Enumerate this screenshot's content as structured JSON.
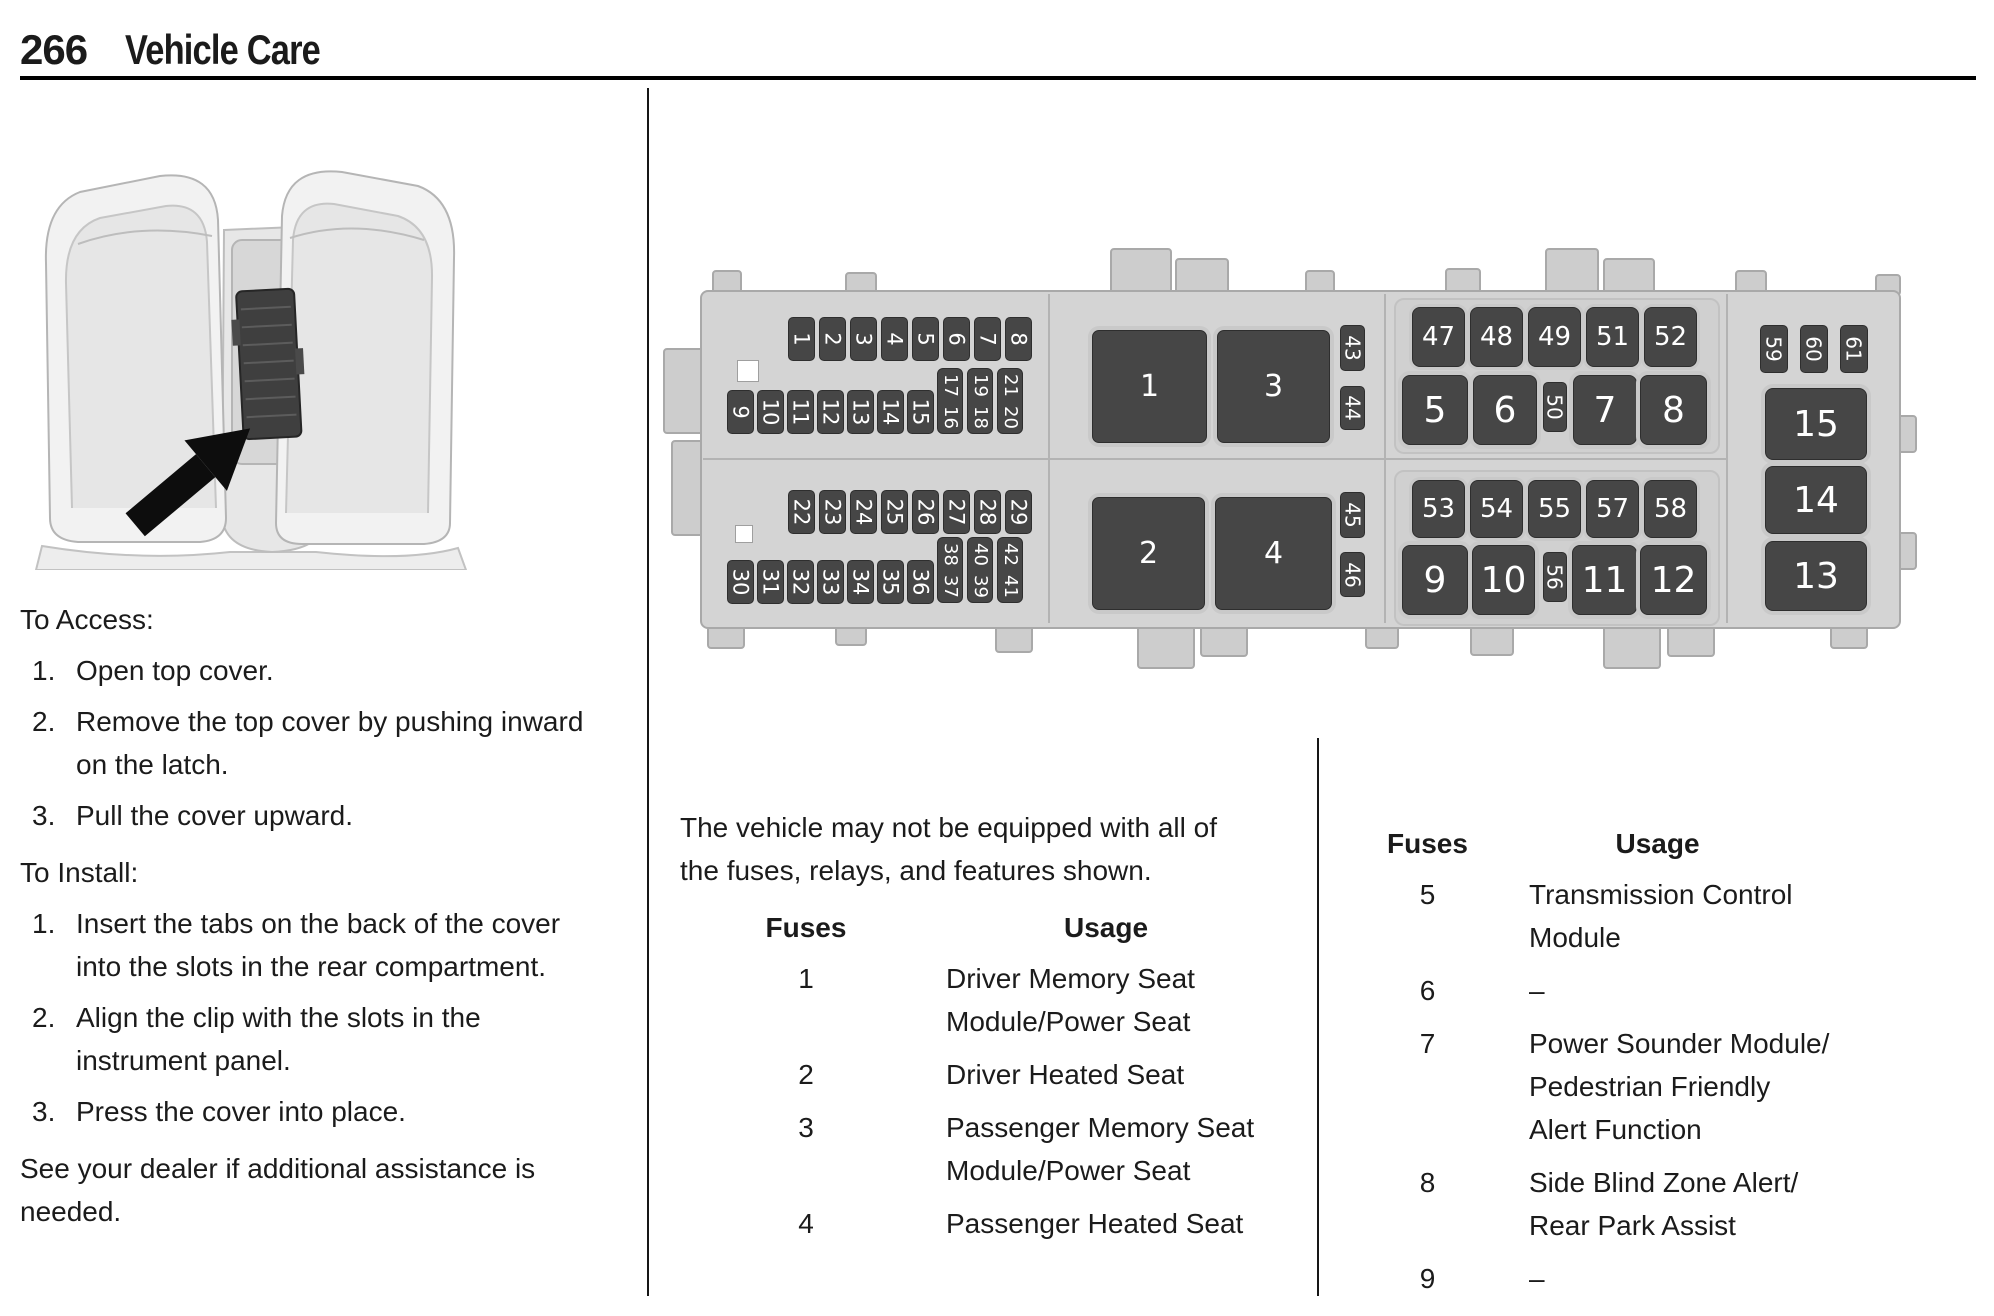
{
  "page": {
    "number": "266",
    "section_title": "Vehicle Care"
  },
  "left_column": {
    "access_heading": "To Access:",
    "access_steps": [
      {
        "num": "1.",
        "lines": [
          "Open top cover."
        ]
      },
      {
        "num": "2.",
        "lines": [
          "Remove the top cover by pushing inward",
          "on the latch."
        ]
      },
      {
        "num": "3.",
        "lines": [
          "Pull the cover upward."
        ]
      }
    ],
    "install_heading": "To Install:",
    "install_steps": [
      {
        "num": "1.",
        "lines": [
          "Insert the tabs on the back of the cover",
          "into the slots in the rear compartment."
        ]
      },
      {
        "num": "2.",
        "lines": [
          "Align the clip with the slots in the",
          "instrument panel."
        ]
      },
      {
        "num": "3.",
        "lines": [
          "Press the cover into place."
        ]
      }
    ],
    "dealer_note_lines": [
      "See your dealer if additional assistance is",
      "needed."
    ]
  },
  "middle_column": {
    "equipment_note_lines": [
      "The vehicle may not be equipped with all of",
      "the fuses, relays, and features shown."
    ],
    "table": {
      "fuses_header": "Fuses",
      "usage_header": "Usage",
      "rows": [
        {
          "fuse": "1",
          "usage_lines": [
            "Driver Memory Seat",
            "Module/Power Seat"
          ]
        },
        {
          "fuse": "2",
          "usage_lines": [
            "Driver Heated Seat"
          ]
        },
        {
          "fuse": "3",
          "usage_lines": [
            "Passenger Memory Seat",
            "Module/Power Seat"
          ]
        },
        {
          "fuse": "4",
          "usage_lines": [
            "Passenger Heated Seat"
          ]
        }
      ]
    }
  },
  "right_column": {
    "table": {
      "fuses_header": "Fuses",
      "usage_header": "Usage",
      "rows": [
        {
          "fuse": "5",
          "usage_lines": [
            "Transmission Control",
            "Module"
          ]
        },
        {
          "fuse": "6",
          "usage_lines": [
            "–"
          ]
        },
        {
          "fuse": "7",
          "usage_lines": [
            "Power Sounder Module/",
            "Pedestrian Friendly",
            "Alert Function"
          ]
        },
        {
          "fuse": "8",
          "usage_lines": [
            "Side Blind Zone Alert/",
            "Rear Park Assist"
          ]
        },
        {
          "fuse": "9",
          "usage_lines": [
            "–"
          ]
        }
      ]
    }
  },
  "diagram": {
    "fuses": [
      {
        "kind": "small",
        "label": "1",
        "x": 243,
        "y": 77,
        "w": 27,
        "h": 44
      },
      {
        "kind": "small",
        "label": "2",
        "x": 274,
        "y": 77,
        "w": 27,
        "h": 44
      },
      {
        "kind": "small",
        "label": "3",
        "x": 305,
        "y": 77,
        "w": 27,
        "h": 44
      },
      {
        "kind": "small",
        "label": "4",
        "x": 336,
        "y": 77,
        "w": 27,
        "h": 44
      },
      {
        "kind": "small",
        "label": "5",
        "x": 367,
        "y": 77,
        "w": 27,
        "h": 44
      },
      {
        "kind": "small",
        "label": "6",
        "x": 398,
        "y": 77,
        "w": 27,
        "h": 44
      },
      {
        "kind": "small",
        "label": "7",
        "x": 429,
        "y": 77,
        "w": 27,
        "h": 44
      },
      {
        "kind": "small",
        "label": "8",
        "x": 460,
        "y": 77,
        "w": 27,
        "h": 44
      },
      {
        "kind": "small",
        "label": "9",
        "x": 182,
        "y": 150,
        "w": 27,
        "h": 44
      },
      {
        "kind": "small",
        "label": "10",
        "x": 212,
        "y": 150,
        "w": 27,
        "h": 44
      },
      {
        "kind": "small",
        "label": "11",
        "x": 242,
        "y": 150,
        "w": 27,
        "h": 44
      },
      {
        "kind": "small",
        "label": "12",
        "x": 272,
        "y": 150,
        "w": 27,
        "h": 44
      },
      {
        "kind": "small",
        "label": "13",
        "x": 302,
        "y": 150,
        "w": 27,
        "h": 44
      },
      {
        "kind": "small",
        "label": "14",
        "x": 332,
        "y": 150,
        "w": 27,
        "h": 44
      },
      {
        "kind": "small",
        "label": "15",
        "x": 362,
        "y": 150,
        "w": 27,
        "h": 44
      },
      {
        "kind": "pair",
        "labels": [
          "17",
          "16"
        ],
        "x": 392,
        "y": 128,
        "w": 26,
        "h": 66
      },
      {
        "kind": "pair",
        "labels": [
          "19",
          "18"
        ],
        "x": 422,
        "y": 128,
        "w": 26,
        "h": 66
      },
      {
        "kind": "pair",
        "labels": [
          "21",
          "20"
        ],
        "x": 452,
        "y": 128,
        "w": 26,
        "h": 66
      },
      {
        "kind": "small",
        "label": "22",
        "x": 243,
        "y": 250,
        "w": 27,
        "h": 44
      },
      {
        "kind": "small",
        "label": "23",
        "x": 274,
        "y": 250,
        "w": 27,
        "h": 44
      },
      {
        "kind": "small",
        "label": "24",
        "x": 305,
        "y": 250,
        "w": 27,
        "h": 44
      },
      {
        "kind": "small",
        "label": "25",
        "x": 336,
        "y": 250,
        "w": 27,
        "h": 44
      },
      {
        "kind": "small",
        "label": "26",
        "x": 367,
        "y": 250,
        "w": 27,
        "h": 44
      },
      {
        "kind": "small",
        "label": "27",
        "x": 398,
        "y": 250,
        "w": 27,
        "h": 44
      },
      {
        "kind": "small",
        "label": "28",
        "x": 429,
        "y": 250,
        "w": 27,
        "h": 44
      },
      {
        "kind": "small",
        "label": "29",
        "x": 460,
        "y": 250,
        "w": 27,
        "h": 44
      },
      {
        "kind": "small",
        "label": "30",
        "x": 182,
        "y": 320,
        "w": 27,
        "h": 44
      },
      {
        "kind": "small",
        "label": "31",
        "x": 212,
        "y": 320,
        "w": 27,
        "h": 44
      },
      {
        "kind": "small",
        "label": "32",
        "x": 242,
        "y": 320,
        "w": 27,
        "h": 44
      },
      {
        "kind": "small",
        "label": "33",
        "x": 272,
        "y": 320,
        "w": 27,
        "h": 44
      },
      {
        "kind": "small",
        "label": "34",
        "x": 302,
        "y": 320,
        "w": 27,
        "h": 44
      },
      {
        "kind": "small",
        "label": "35",
        "x": 332,
        "y": 320,
        "w": 27,
        "h": 44
      },
      {
        "kind": "small",
        "label": "36",
        "x": 362,
        "y": 320,
        "w": 27,
        "h": 44
      },
      {
        "kind": "pair",
        "labels": [
          "38",
          "37"
        ],
        "x": 392,
        "y": 297,
        "w": 26,
        "h": 66
      },
      {
        "kind": "pair",
        "labels": [
          "40",
          "39"
        ],
        "x": 422,
        "y": 297,
        "w": 26,
        "h": 66
      },
      {
        "kind": "pair",
        "labels": [
          "42",
          "41"
        ],
        "x": 452,
        "y": 297,
        "w": 26,
        "h": 66
      },
      {
        "kind": "relay",
        "label": "1",
        "x": 547,
        "y": 90,
        "w": 115,
        "h": 113
      },
      {
        "kind": "relay",
        "label": "3",
        "x": 672,
        "y": 90,
        "w": 113,
        "h": 113
      },
      {
        "kind": "tiny",
        "label": "43",
        "x": 795,
        "y": 85,
        "w": 25,
        "h": 46
      },
      {
        "kind": "tiny",
        "label": "44",
        "x": 795,
        "y": 146,
        "w": 25,
        "h": 44
      },
      {
        "kind": "relay",
        "label": "2",
        "x": 547,
        "y": 257,
        "w": 113,
        "h": 113
      },
      {
        "kind": "relay",
        "label": "4",
        "x": 670,
        "y": 257,
        "w": 117,
        "h": 113
      },
      {
        "kind": "tiny",
        "label": "45",
        "x": 795,
        "y": 252,
        "w": 25,
        "h": 46
      },
      {
        "kind": "tiny",
        "label": "46",
        "x": 795,
        "y": 312,
        "w": 25,
        "h": 45
      },
      {
        "kind": "med",
        "label": "47",
        "x": 867,
        "y": 67,
        "w": 53,
        "h": 60
      },
      {
        "kind": "med",
        "label": "48",
        "x": 925,
        "y": 67,
        "w": 53,
        "h": 60
      },
      {
        "kind": "med",
        "label": "49",
        "x": 983,
        "y": 67,
        "w": 53,
        "h": 60
      },
      {
        "kind": "med",
        "label": "51",
        "x": 1041,
        "y": 67,
        "w": 53,
        "h": 60
      },
      {
        "kind": "med",
        "label": "52",
        "x": 1099,
        "y": 67,
        "w": 53,
        "h": 60
      },
      {
        "kind": "large",
        "label": "5",
        "x": 857,
        "y": 135,
        "w": 66,
        "h": 70
      },
      {
        "kind": "large",
        "label": "6",
        "x": 928,
        "y": 135,
        "w": 64,
        "h": 70
      },
      {
        "kind": "tiny",
        "label": "50",
        "x": 998,
        "y": 142,
        "w": 24,
        "h": 50
      },
      {
        "kind": "large",
        "label": "7",
        "x": 1028,
        "y": 135,
        "w": 64,
        "h": 70
      },
      {
        "kind": "large",
        "label": "8",
        "x": 1095,
        "y": 135,
        "w": 67,
        "h": 70
      },
      {
        "kind": "med",
        "label": "53",
        "x": 867,
        "y": 240,
        "w": 53,
        "h": 58
      },
      {
        "kind": "med",
        "label": "54",
        "x": 925,
        "y": 240,
        "w": 53,
        "h": 58
      },
      {
        "kind": "med",
        "label": "55",
        "x": 983,
        "y": 240,
        "w": 53,
        "h": 58
      },
      {
        "kind": "med",
        "label": "57",
        "x": 1041,
        "y": 240,
        "w": 53,
        "h": 58
      },
      {
        "kind": "med",
        "label": "58",
        "x": 1099,
        "y": 240,
        "w": 53,
        "h": 58
      },
      {
        "kind": "large",
        "label": "9",
        "x": 857,
        "y": 305,
        "w": 66,
        "h": 70
      },
      {
        "kind": "large",
        "label": "10",
        "x": 927,
        "y": 305,
        "w": 63,
        "h": 70
      },
      {
        "kind": "tiny",
        "label": "56",
        "x": 998,
        "y": 312,
        "w": 24,
        "h": 50
      },
      {
        "kind": "large",
        "label": "11",
        "x": 1027,
        "y": 305,
        "w": 65,
        "h": 70
      },
      {
        "kind": "large",
        "label": "12",
        "x": 1095,
        "y": 305,
        "w": 67,
        "h": 70
      },
      {
        "kind": "tiny",
        "label": "59",
        "x": 1215,
        "y": 85,
        "w": 28,
        "h": 48
      },
      {
        "kind": "tiny",
        "label": "60",
        "x": 1255,
        "y": 85,
        "w": 28,
        "h": 48
      },
      {
        "kind": "tiny",
        "label": "61",
        "x": 1295,
        "y": 85,
        "w": 28,
        "h": 48
      },
      {
        "kind": "wide",
        "label": "15",
        "x": 1220,
        "y": 148,
        "w": 102,
        "h": 72
      },
      {
        "kind": "wide",
        "label": "14",
        "x": 1220,
        "y": 226,
        "w": 102,
        "h": 68
      },
      {
        "kind": "wide",
        "label": "13",
        "x": 1220,
        "y": 301,
        "w": 102,
        "h": 70
      }
    ]
  },
  "colors": {
    "fuse_block": "#464646",
    "panel_body": "#d4d4d4"
  }
}
